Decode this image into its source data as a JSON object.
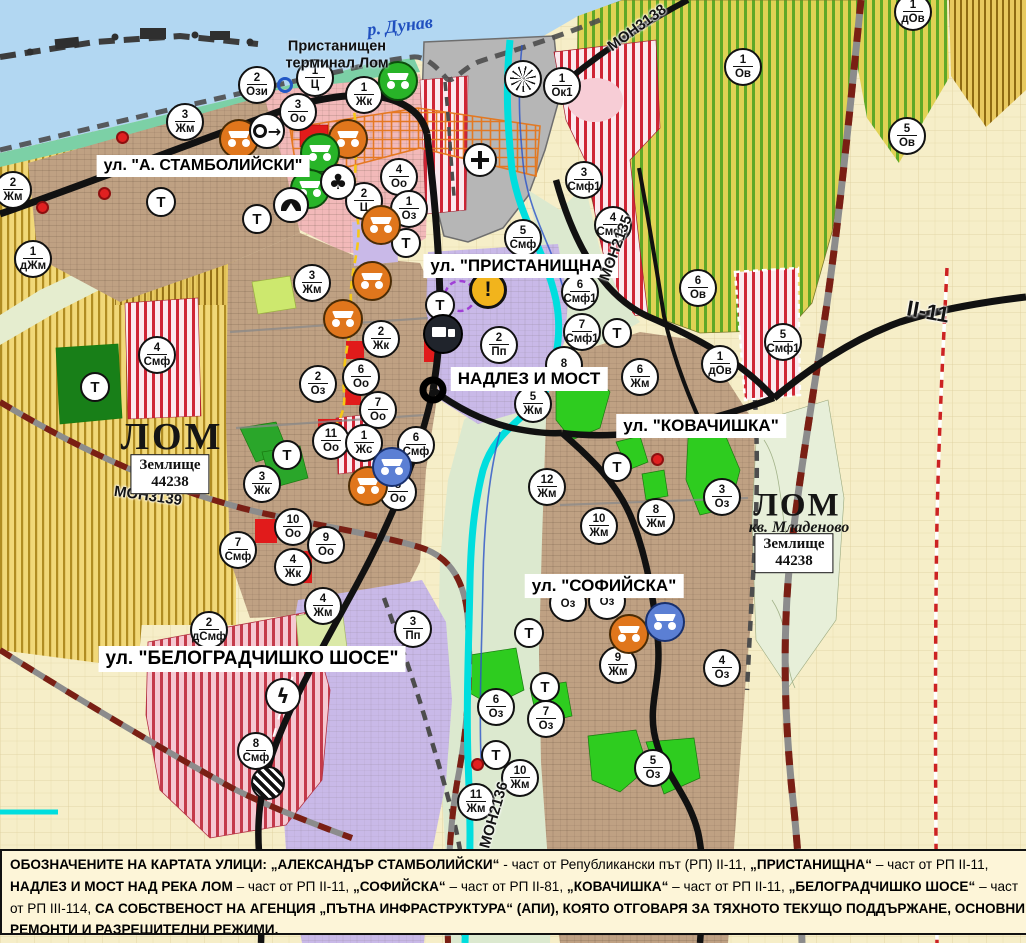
{
  "map": {
    "water_label": {
      "text": "р. Дунав",
      "x": 400,
      "y": 26
    },
    "port_terminal": {
      "lines": [
        "Пристанищен",
        "терминал Лом"
      ],
      "x": 337,
      "y": 55
    },
    "street_labels": [
      {
        "text": "ул. \"А. СТАМБОЛИЙСКИ\"",
        "x": 203,
        "y": 166
      },
      {
        "text": "ул. \"ПРИСТАНИЩНА\"",
        "x": 521,
        "y": 266
      },
      {
        "text": "НАДЛЕЗ И МОСТ",
        "x": 529,
        "y": 379
      },
      {
        "text": "ул. \"КОВАЧИШКА\"",
        "x": 701,
        "y": 426
      },
      {
        "text": "ул. \"СОФИЙСКА\"",
        "x": 604,
        "y": 586
      },
      {
        "text": "ул. \"БЕЛОГРАДЧИШКО ШОСЕ\"",
        "x": 252,
        "y": 659
      }
    ],
    "road_labels": [
      {
        "text": "MOН3138",
        "x": 637,
        "y": 28,
        "rot": -36,
        "big": false
      },
      {
        "text": "MOН2135",
        "x": 616,
        "y": 248,
        "rot": -70,
        "big": false
      },
      {
        "text": "MOН3139",
        "x": 148,
        "y": 496,
        "rot": 8,
        "big": false
      },
      {
        "text": "MOН2136",
        "x": 494,
        "y": 815,
        "rot": -74,
        "big": false
      },
      {
        "text": "II-11",
        "x": 928,
        "y": 312,
        "rot": 10,
        "big": true
      }
    ],
    "place_labels": [
      {
        "kind": "city",
        "text": "ЛОМ",
        "x": 172,
        "y": 437,
        "small": false
      },
      {
        "kind": "city",
        "text": "ЛОМ",
        "x": 797,
        "y": 506,
        "small": true
      },
      {
        "kind": "sub",
        "text": "кв. Младеново",
        "x": 799,
        "y": 528
      },
      {
        "kind": "landplot",
        "lines": [
          "Землище",
          "44238"
        ],
        "x": 170,
        "y": 474
      },
      {
        "kind": "landplot",
        "lines": [
          "Землище",
          "44238"
        ],
        "x": 794,
        "y": 553
      }
    ],
    "zone_markers": [
      {
        "n": "1",
        "c": "Ц",
        "x": 315,
        "y": 78
      },
      {
        "n": "2",
        "c": "Ози",
        "x": 257,
        "y": 85
      },
      {
        "n": "1",
        "c": "Жк",
        "x": 364,
        "y": 95
      },
      {
        "n": "3",
        "c": "Оо",
        "x": 298,
        "y": 112
      },
      {
        "n": "3",
        "c": "Жм",
        "x": 185,
        "y": 122
      },
      {
        "n": "2",
        "c": "Жм",
        "x": 13,
        "y": 190
      },
      {
        "n": "1",
        "c": "дЖм",
        "x": 33,
        "y": 259
      },
      {
        "n": "4",
        "c": "Оо",
        "x": 399,
        "y": 177
      },
      {
        "n": "2",
        "c": "Ц",
        "x": 364,
        "y": 201
      },
      {
        "n": "1",
        "c": "Оз",
        "x": 409,
        "y": 209
      },
      {
        "n": "1",
        "c": "Ок1",
        "x": 562,
        "y": 86
      },
      {
        "n": "3",
        "c": "Смф1",
        "x": 584,
        "y": 180
      },
      {
        "n": "4",
        "c": "Смф1",
        "x": 613,
        "y": 225
      },
      {
        "n": "5",
        "c": "Смф",
        "x": 523,
        "y": 238
      },
      {
        "n": "1",
        "c": "Ов",
        "x": 743,
        "y": 67
      },
      {
        "n": "5",
        "c": "Ов",
        "x": 907,
        "y": 136
      },
      {
        "n": "1",
        "c": "дОв",
        "x": 913,
        "y": 12
      },
      {
        "n": "6",
        "c": "Ов",
        "x": 698,
        "y": 288
      },
      {
        "n": "6",
        "c": "Смф1",
        "x": 580,
        "y": 292
      },
      {
        "n": "7",
        "c": "Смф1",
        "x": 582,
        "y": 332
      },
      {
        "n": "5",
        "c": "Смф1",
        "x": 783,
        "y": 342
      },
      {
        "n": "1",
        "c": "дОв",
        "x": 720,
        "y": 364
      },
      {
        "n": "8",
        "c": "",
        "x": 564,
        "y": 365
      },
      {
        "n": "6",
        "c": "Жм",
        "x": 640,
        "y": 377
      },
      {
        "n": "5",
        "c": "Жм",
        "x": 533,
        "y": 404
      },
      {
        "n": "2",
        "c": "Пп",
        "x": 499,
        "y": 345
      },
      {
        "n": "3",
        "c": "Жм",
        "x": 312,
        "y": 283
      },
      {
        "n": "2",
        "c": "Жк",
        "x": 381,
        "y": 339
      },
      {
        "n": "2",
        "c": "Оз",
        "x": 318,
        "y": 384
      },
      {
        "n": "6",
        "c": "Оо",
        "x": 361,
        "y": 377
      },
      {
        "n": "7",
        "c": "Оо",
        "x": 378,
        "y": 410
      },
      {
        "n": "11",
        "c": "Оо",
        "x": 331,
        "y": 441
      },
      {
        "n": "1",
        "c": "Жс",
        "x": 364,
        "y": 443
      },
      {
        "n": "6",
        "c": "Смф",
        "x": 416,
        "y": 445
      },
      {
        "n": "8",
        "c": "Оо",
        "x": 398,
        "y": 492
      },
      {
        "n": "10",
        "c": "Оо",
        "x": 293,
        "y": 527
      },
      {
        "n": "9",
        "c": "Оо",
        "x": 326,
        "y": 545
      },
      {
        "n": "4",
        "c": "Жк",
        "x": 293,
        "y": 567
      },
      {
        "n": "7",
        "c": "Смф",
        "x": 238,
        "y": 550
      },
      {
        "n": "3",
        "c": "Жк",
        "x": 262,
        "y": 484
      },
      {
        "n": "4",
        "c": "Смф",
        "x": 157,
        "y": 355
      },
      {
        "n": "12",
        "c": "Жм",
        "x": 547,
        "y": 487
      },
      {
        "n": "10",
        "c": "Жм",
        "x": 599,
        "y": 526
      },
      {
        "n": "8",
        "c": "Жм",
        "x": 656,
        "y": 517
      },
      {
        "n": "3",
        "c": "Оз",
        "x": 722,
        "y": 497
      },
      {
        "n": "9",
        "c": "Жм",
        "x": 618,
        "y": 665
      },
      {
        "n": "4",
        "c": "Оз",
        "x": 722,
        "y": 668
      },
      {
        "n": "",
        "c": "Оз",
        "x": 568,
        "y": 603
      },
      {
        "n": "",
        "c": "Оз",
        "x": 607,
        "y": 601
      },
      {
        "n": "6",
        "c": "Оз",
        "x": 496,
        "y": 707
      },
      {
        "n": "7",
        "c": "Оз",
        "x": 546,
        "y": 719
      },
      {
        "n": "10",
        "c": "Жм",
        "x": 520,
        "y": 778
      },
      {
        "n": "11",
        "c": "Жм",
        "x": 476,
        "y": 802
      },
      {
        "n": "5",
        "c": "Оз",
        "x": 653,
        "y": 768
      },
      {
        "n": "2",
        "c": "дСмф",
        "x": 209,
        "y": 630
      },
      {
        "n": "4",
        "c": "Жм",
        "x": 323,
        "y": 606
      },
      {
        "n": "3",
        "c": "Пп",
        "x": 413,
        "y": 629
      },
      {
        "n": "8",
        "c": "Смф",
        "x": 256,
        "y": 751
      }
    ],
    "t_markers": [
      {
        "x": 161,
        "y": 202
      },
      {
        "x": 257,
        "y": 219
      },
      {
        "x": 406,
        "y": 243
      },
      {
        "x": 440,
        "y": 305
      },
      {
        "x": 95,
        "y": 387
      },
      {
        "x": 287,
        "y": 455
      },
      {
        "x": 617,
        "y": 333
      },
      {
        "x": 617,
        "y": 467
      },
      {
        "x": 529,
        "y": 633
      },
      {
        "x": 545,
        "y": 687
      },
      {
        "x": 496,
        "y": 755
      }
    ],
    "icons": [
      {
        "type": "monument-orange",
        "x": 239,
        "y": 139
      },
      {
        "type": "monument-orange",
        "x": 348,
        "y": 139
      },
      {
        "type": "monument-orange",
        "x": 381,
        "y": 225
      },
      {
        "type": "monument-orange",
        "x": 372,
        "y": 281
      },
      {
        "type": "monument-orange",
        "x": 343,
        "y": 319
      },
      {
        "type": "monument-orange",
        "x": 368,
        "y": 486
      },
      {
        "type": "monument-orange",
        "x": 629,
        "y": 634
      },
      {
        "type": "monument-green",
        "x": 398,
        "y": 81
      },
      {
        "type": "monument-green",
        "x": 320,
        "y": 153
      },
      {
        "type": "monument-green",
        "x": 310,
        "y": 189
      },
      {
        "type": "monument-blue",
        "x": 392,
        "y": 467
      },
      {
        "type": "monument-blue",
        "x": 665,
        "y": 622
      },
      {
        "type": "arrow-sign",
        "x": 267,
        "y": 131
      },
      {
        "type": "club-sign",
        "x": 338,
        "y": 182
      },
      {
        "type": "tunnel-sign",
        "x": 291,
        "y": 205
      },
      {
        "type": "fan-sign",
        "x": 523,
        "y": 79
      },
      {
        "type": "cross-sign",
        "x": 480,
        "y": 160
      },
      {
        "type": "warning-sign",
        "x": 488,
        "y": 290
      },
      {
        "type": "truck-sign",
        "x": 443,
        "y": 334
      },
      {
        "type": "lightning-sign",
        "x": 283,
        "y": 696
      },
      {
        "type": "railcross-sign",
        "x": 268,
        "y": 783
      },
      {
        "type": "blue-ring",
        "x": 285,
        "y": 85
      }
    ],
    "red_dots": [
      {
        "x": 122,
        "y": 137
      },
      {
        "x": 104,
        "y": 193
      },
      {
        "x": 42,
        "y": 207
      },
      {
        "x": 657,
        "y": 459
      },
      {
        "x": 477,
        "y": 764
      }
    ]
  },
  "legend_note": {
    "parts": [
      {
        "t": "ОБОЗНАЧЕНИТЕ НА КАРТАТА УЛИЦИ: ",
        "b": true
      },
      {
        "t": "„АЛЕКСАНДЪР СТАМБОЛИЙСКИ“",
        "b": true
      },
      {
        "t": " - част от Републикански път (РП) II-11, ",
        "b": false
      },
      {
        "t": "„ПРИСТАНИЩНА“",
        "b": true
      },
      {
        "t": " – част от РП II-11, ",
        "b": false
      },
      {
        "t": "НАДЛЕЗ И МОСТ НАД РЕКА ЛОМ",
        "b": true
      },
      {
        "t": " – част от РП II-11, ",
        "b": false
      },
      {
        "t": "„СОФИЙСКА“",
        "b": true
      },
      {
        "t": " – част от РП II-81, ",
        "b": false
      },
      {
        "t": "„КОВАЧИШКА“",
        "b": true
      },
      {
        "t": " – част от РП II-11, ",
        "b": false
      },
      {
        "t": "„БЕЛОГРАДЧИШКО ШОСЕ“",
        "b": true
      },
      {
        "t": " – част от РП III-114, ",
        "b": false
      },
      {
        "t": "СА СОБСТВЕНОСТ НА АГЕНЦИЯ „ПЪТНА ИНФРАСТРУКТУРА“ (АПИ), КОЯТО ОТГОВАРЯ ЗА ТЯХНОТО ТЕКУЩО ПОДДЪРЖАНЕ, ОСНОВНИ РЕМОНТИ И РАЗРЕШИТЕЛНИ РЕЖИМИ.",
        "b": true
      }
    ]
  },
  "colors": {
    "water": "#b2d7f2",
    "shore": "#7cd0a6",
    "agri_yellow": "#f1d878",
    "agri_stripe": "#b08c22",
    "fields_pale": "#f6eec8",
    "urban_brown": "#bfa183",
    "pink_zone": "#f2b9b9",
    "red_stripe": "#cf2535",
    "lavender": "#c9b9e8",
    "vineyard_base": "#e0d254",
    "vineyard_stripe": "#5fa827",
    "park_green": "#2ecc1f",
    "dark_green": "#187f18",
    "river_cyan": "#00dede",
    "road_black": "#111111",
    "rail_red": "#7a1f14",
    "port_grey": "#b6b6b6",
    "banner_bg": "#fdf5d8",
    "monument_orange": "#e0761c",
    "monument_green": "#28b428",
    "monument_blue": "#5b7fd4",
    "warning_yellow": "#f2b41c"
  }
}
